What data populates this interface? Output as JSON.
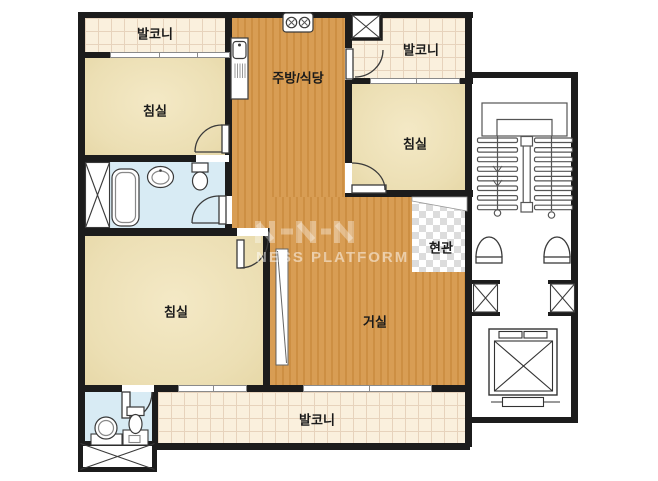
{
  "rooms": {
    "balcony_top_left": {
      "label": "발코니"
    },
    "kitchen_dining": {
      "label": "주방/식당"
    },
    "balcony_top_right": {
      "label": "발코니"
    },
    "bedroom_top_left": {
      "label": "침실"
    },
    "bedroom_top_right": {
      "label": "침실"
    },
    "bedroom_bottom_left": {
      "label": "침실"
    },
    "living_room": {
      "label": "거실"
    },
    "entrance": {
      "label": "현관"
    },
    "balcony_bottom": {
      "label": "발코니"
    }
  },
  "watermark": {
    "brand_text": "NESS PLATFORM"
  },
  "icons": [
    "stove-burner-icon",
    "sink-icon",
    "bathtub-icon",
    "washbasin-icon",
    "toilet-icon",
    "closet-x-icon",
    "duct-x-icon",
    "elevator-x-icon",
    "staircase-icon",
    "door-swing-icon"
  ],
  "colors": {
    "wall": "#1c1c1c",
    "wood_floor": "#d69a4e",
    "bedroom_floor": "#ecdfb4",
    "balcony_floor": "#faf0dd",
    "bathroom_floor": "#d8ebf4",
    "entry_checker": "#dcdcdc",
    "line_art": "#3a3a3a"
  }
}
